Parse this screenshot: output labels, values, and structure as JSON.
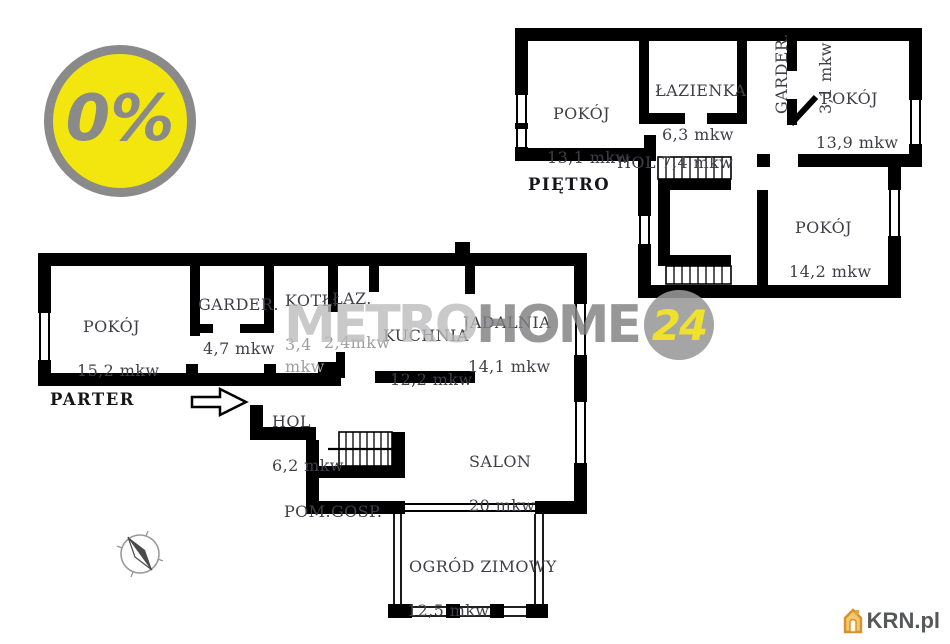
{
  "badge": {
    "text": "0%",
    "bg_color": "#f2e60e",
    "ring_color": "#8a8a8a"
  },
  "watermark": {
    "metro": "METRO",
    "home": "HOME",
    "badge24": "24",
    "circle_color": "#989898",
    "num_color": "#f0e12c"
  },
  "logo": {
    "text": "KRN.pl",
    "text_color": "#57585a",
    "house_color": "#dfa146"
  },
  "colors": {
    "wall": "#000000",
    "label": "#3f3f49",
    "label_faded": "#9e9e9e"
  },
  "floors": {
    "pietro": {
      "label": "PIĘTRO",
      "rooms": [
        {
          "name": "POKÓJ",
          "area": "13,1 mkw"
        },
        {
          "name": "ŁAZIENKA",
          "area": "6,3 mkw"
        },
        {
          "name": "GARDER.",
          "area": "3,1 mkw"
        },
        {
          "name": "POKÓJ",
          "area": "13,9 mkw"
        },
        {
          "name": "HOL 7,4 mkw",
          "area": ""
        },
        {
          "name": "POKÓJ",
          "area": "14,2 mkw"
        }
      ]
    },
    "parter": {
      "label": "PARTER",
      "rooms": [
        {
          "name": "POKÓJ",
          "area": "15,2 mkw"
        },
        {
          "name": "GARDER.",
          "area": "4,7 mkw"
        },
        {
          "name": "KOTŁ.",
          "area": "3,4\nmkw"
        },
        {
          "name": "ŁAZ.",
          "area": "2,4mkw"
        },
        {
          "name": "KUCHNIA",
          "area": "12,2 mkw"
        },
        {
          "name": "JADALNIA",
          "area": "14,1 mkw"
        },
        {
          "name": "HOL",
          "area": "6,2 mkw"
        },
        {
          "name": "SALON",
          "area": "20 mkw"
        },
        {
          "name": "POM.GOSP.",
          "area": ""
        },
        {
          "name": "OGRÓD ZIMOWY",
          "area": "12,5 mkw"
        }
      ]
    }
  }
}
